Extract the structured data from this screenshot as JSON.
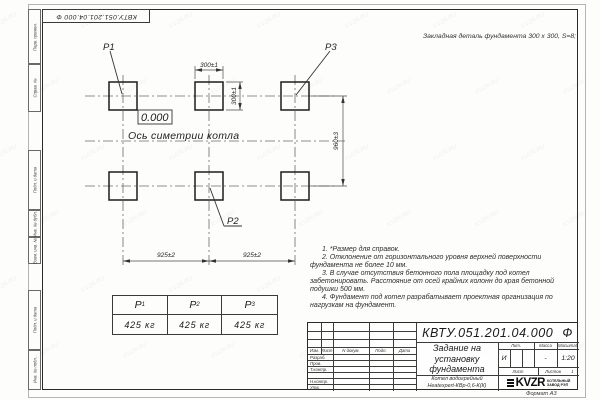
{
  "watermark": "KVZR.RU",
  "stamp": {
    "text": "КВТУ.051.201.04.000  Ф"
  },
  "embed_note": "Закладная деталь фундамента  300 x 300,  S=8;",
  "drawing": {
    "p1": "P1",
    "p2": "P2",
    "p3": "P3",
    "level_mark": "0.000",
    "axis_label": "Ось симетрии котла",
    "dim_width": "300±1",
    "dim_height": "300±1",
    "dim_rows": "960±3",
    "dim_col1": "925±2",
    "dim_col2": "925±2"
  },
  "notes": [
    "1. *Размер для справок.",
    "2. Отклонение от горизонтального уровня верхней поверхности фундамента не более 10 мм.",
    "3. В случае отсутствия бетонного пола площадку под котел забетонировать. Расстояние от осей крайних колонн до края бетонной подушки 500 мм.",
    "4. Фундамент под котел разрабатывает проектная организация по нагрузкам на фундамент."
  ],
  "load_table": {
    "headers": [
      {
        "base": "P",
        "sub": "1"
      },
      {
        "base": "P",
        "sub": "2"
      },
      {
        "base": "P",
        "sub": "3"
      }
    ],
    "values": [
      "425 кг",
      "425 кг",
      "425 кг"
    ]
  },
  "title_block": {
    "doc_number": "КВТУ.051.201.04.000",
    "doc_suffix": "Ф",
    "title_lines": [
      "Задание на",
      "установку",
      "фундамента"
    ],
    "product_lines": [
      "Котел водогрейный",
      "Heatexpert-КВр-0,6-К(К)"
    ],
    "col_izm": "Изм.",
    "col_list": "Лист",
    "col_ndokum": "N докум.",
    "col_podp": "Подп.",
    "col_data": "Дата",
    "row_razrab": "Разраб.",
    "row_prov": "Пров.",
    "row_tkontr": "Т.контр.",
    "row_nkontr": "Н.контр.",
    "row_utv": "Утв.",
    "lit_label": "Лит.",
    "massa_label": "Масса",
    "scale_label": "Масштаб",
    "lit_value": "И",
    "massa_value": "-",
    "scale_value": "1:20",
    "list_label": "Лист",
    "listov_label": "Листов",
    "listov_value": "1",
    "logo_text": "KVZR",
    "org_lines": [
      "КОТЕЛЬНЫЙ",
      "ЗАВОД РЭП"
    ]
  },
  "side_strip": {
    "items": [
      "Перв. примен.",
      "Справ. №",
      "Подп. и дата",
      "Инв. № дубл.",
      "Взам. инв. №",
      "Подп. и дата",
      "Инв. № подл."
    ]
  },
  "format_label": "Формат А3"
}
